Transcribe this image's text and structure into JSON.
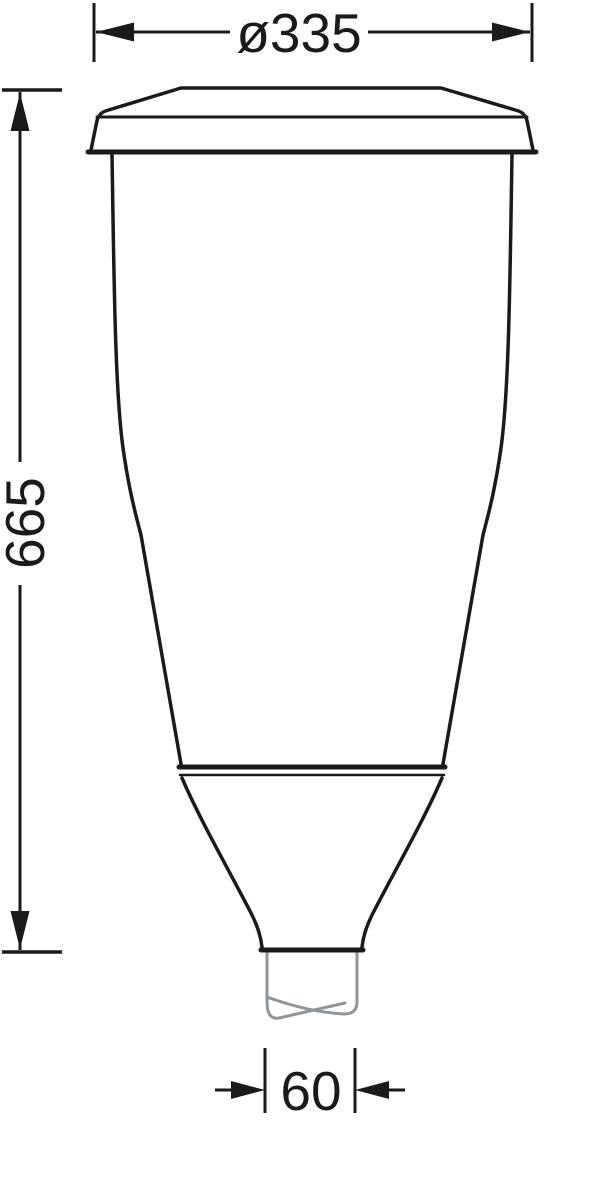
{
  "colors": {
    "line": "#1a1a1a",
    "pole": "#8f9598",
    "background": "#ffffff"
  },
  "dimensions": {
    "top_diameter": "ø335",
    "height": "665",
    "bottom_diameter": "60"
  }
}
